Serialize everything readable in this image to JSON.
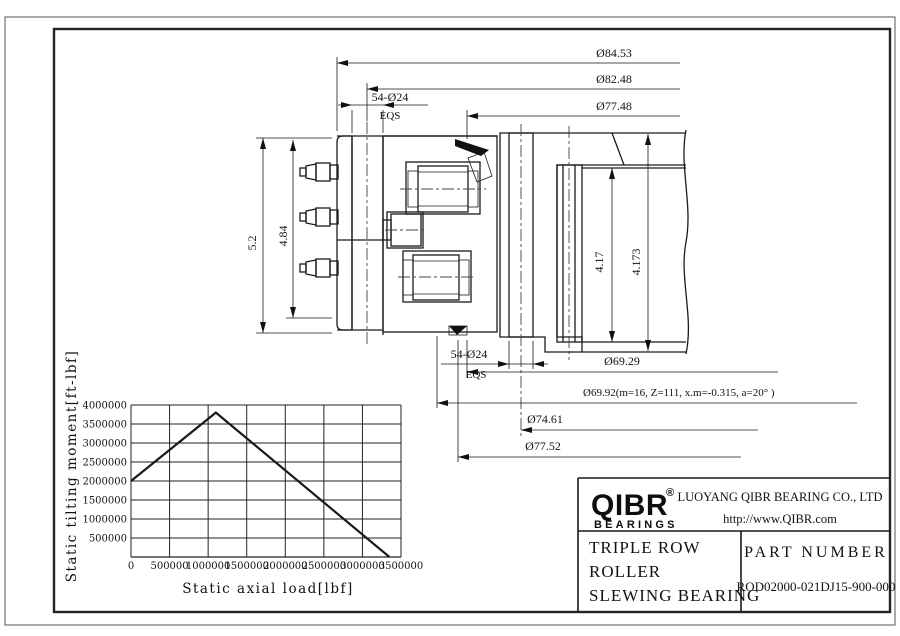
{
  "drawing": {
    "dims": {
      "d84": "Ø84.53",
      "d82": "Ø82.48",
      "d77_48": "Ø77.48",
      "bolt_top_label": "54-Ø24",
      "bolt_top_eqs": "EQS",
      "bolt_bottom_label": "54-Ø24",
      "bolt_bottom_eqs": "EQS",
      "h52": "5.2",
      "h484": "4.84",
      "g417": "4.17",
      "g4173": "4.173",
      "d69_29": "Ø69.29",
      "gear_note": "Ø69.92(m=16, Z=111, x.m=-0.315, a=20° )",
      "d74_61": "Ø74.61",
      "d77_52": "Ø77.52"
    }
  },
  "chart_data": {
    "type": "line",
    "title": "",
    "xlabel": "Static axial load[lbf]",
    "ylabel": "Static tilting moment[ft-lbf]",
    "xlim": [
      0,
      3500000
    ],
    "ylim": [
      0,
      4000000
    ],
    "grid": true,
    "legend": "none",
    "x_ticks": [
      0,
      500000,
      1000000,
      1500000,
      2000000,
      2500000,
      3000000,
      3500000
    ],
    "y_ticks": [
      500000,
      1000000,
      1500000,
      2000000,
      2500000,
      3000000,
      3500000,
      4000000
    ],
    "series": [
      {
        "name": "static-load-capacity",
        "points": [
          [
            0,
            2000000
          ],
          [
            1100000,
            3800000
          ],
          [
            3350000,
            0
          ]
        ]
      }
    ]
  },
  "title_block": {
    "logo_text": "QIBR",
    "logo_reg": "®",
    "logo_sub": "BEARINGS",
    "company": "LUOYANG QIBR BEARING CO., LTD",
    "website": "http://www.QIBR.com",
    "product_line1": "TRIPLE ROW",
    "product_line2": "ROLLER",
    "product_line3": "SLEWING BEARING",
    "part_number_label": "PART  NUMBER",
    "part_number": "ROD02000-021DJ15-900-000"
  },
  "colors": {
    "line": "#1a1a1a",
    "background": "#ffffff"
  }
}
